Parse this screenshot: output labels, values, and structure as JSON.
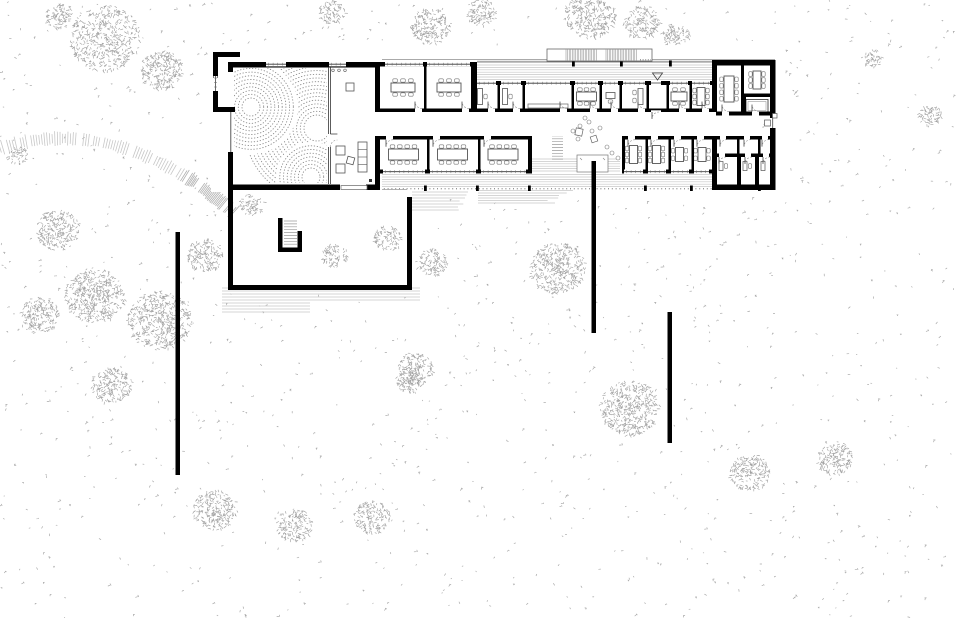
{
  "drawing": {
    "kind": "architectural-site-plan",
    "canvas": {
      "w": 960,
      "h": 618
    },
    "palette": {
      "paper": "#ffffff",
      "wall": "#000000",
      "thin_line": "#444444",
      "furniture": "#777777",
      "hatch": "#c7c7c7",
      "hatch_dark": "#9a9a9a",
      "stipple": "#a9a9a9",
      "zen_dots": "#8a8a8a",
      "door_arc": "#888888"
    },
    "stipple": {
      "count": 1300,
      "seed": 7,
      "exclude": [
        [
          208,
          44,
          575,
          150
        ],
        [
          225,
          183,
          192,
          110
        ]
      ]
    },
    "clusters": [
      [
        105,
        38,
        36
      ],
      [
        162,
        70,
        22
      ],
      [
        60,
        16,
        14
      ],
      [
        332,
        12,
        13
      ],
      [
        430,
        26,
        20
      ],
      [
        482,
        12,
        15
      ],
      [
        590,
        14,
        26
      ],
      [
        642,
        22,
        18
      ],
      [
        676,
        36,
        14
      ],
      [
        872,
        58,
        10
      ],
      [
        930,
        115,
        12
      ],
      [
        18,
        155,
        10
      ],
      [
        58,
        230,
        22
      ],
      [
        95,
        295,
        30
      ],
      [
        40,
        315,
        20
      ],
      [
        160,
        320,
        32
      ],
      [
        205,
        255,
        18
      ],
      [
        252,
        204,
        12
      ],
      [
        335,
        255,
        13
      ],
      [
        388,
        238,
        14
      ],
      [
        432,
        262,
        15
      ],
      [
        558,
        268,
        28
      ],
      [
        415,
        368,
        18
      ],
      [
        112,
        385,
        20
      ],
      [
        630,
        408,
        30
      ],
      [
        750,
        472,
        20
      ],
      [
        835,
        458,
        18
      ],
      [
        215,
        510,
        22
      ],
      [
        295,
        525,
        18
      ],
      [
        372,
        517,
        18
      ],
      [
        410,
        380,
        14
      ]
    ],
    "contour_band": {
      "p0": [
        0,
        148
      ],
      "p1": [
        118,
        112
      ],
      "p2": [
        232,
        212
      ],
      "ticks": 90
    },
    "hatch_blocks": [
      {
        "x1": 476,
        "x2": 712,
        "y": 62.6,
        "step": 2.4,
        "n": 8,
        "shrink": 0,
        "dir": "h"
      },
      {
        "x1": 382,
        "x2": 712,
        "y": 174.6,
        "step": 2.4,
        "n": 6,
        "shrink": 0,
        "dir": "h"
      },
      {
        "x1": 532,
        "x2": 620,
        "y": 159,
        "step": 2.4,
        "n": 6,
        "shrink": 0,
        "dir": "h"
      },
      {
        "x1": 412,
        "x2": 468,
        "y": 192,
        "step": 3,
        "n": 7,
        "shrink": 2,
        "dir": "h"
      },
      {
        "x1": 478,
        "x2": 573,
        "y": 190.5,
        "step": 2.5,
        "n": 6,
        "shrink": 5,
        "dir": "h"
      },
      {
        "x1": 222,
        "x2": 420,
        "y": 288,
        "step": 3,
        "n": 5,
        "shrink": 0,
        "dir": "h"
      },
      {
        "x1": 222,
        "x2": 310,
        "y": 303,
        "step": 3,
        "n": 4,
        "shrink": 0,
        "dir": "h"
      },
      {
        "x1": 552,
        "x2": 563,
        "y": 133,
        "step": 2.9,
        "n": 10,
        "shrink": 0,
        "dir": "h",
        "dark": true
      },
      {
        "x1": 284,
        "x2": 297,
        "y": 221,
        "step": 2.9,
        "n": 9,
        "shrink": 0,
        "dir": "h",
        "dark": true
      },
      {
        "x1": 749,
        "x2": 765,
        "y": 101.5,
        "step": 2.7,
        "n": 7,
        "len": 9,
        "dir": "v",
        "dark": true
      }
    ],
    "edge_lines": {
      "top": [
        378,
        775,
        59.8,
        61.8
      ],
      "dashdot_y": 188.8,
      "dashdot_x": [
        380,
        775
      ],
      "garden_gap_line": [
        380,
        407,
        189.5
      ]
    },
    "ticks_top": [
      572,
      620,
      669
    ],
    "ticks_south": [
      424,
      476,
      528,
      644,
      690,
      758
    ],
    "canopy": {
      "x": 547,
      "y": 49,
      "w": 105,
      "h": 12,
      "strips": [
        [
          566,
          598
        ],
        [
          606,
          638
        ]
      ],
      "dotted": [
        640,
        651,
        59.8
      ]
    },
    "white_fills": [
      [
        211,
        46,
        171,
        146
      ],
      [
        378,
        60,
        99,
        52
      ],
      [
        473,
        81,
        242,
        31
      ],
      [
        378,
        112,
        394,
        24
      ],
      [
        378,
        136,
        154,
        37
      ],
      [
        622,
        136,
        92,
        37
      ],
      [
        712,
        60,
        64,
        130
      ],
      [
        577,
        155,
        31,
        17
      ]
    ],
    "walls": [
      [
        233,
        62,
        147,
        5.5
      ],
      [
        228,
        62,
        5,
        10
      ],
      [
        228,
        152,
        5,
        38
      ],
      [
        228,
        184.5,
        112,
        5.5
      ],
      [
        366,
        184.5,
        14,
        5.5
      ],
      [
        375,
        62,
        5,
        50
      ],
      [
        375,
        136,
        5,
        54
      ],
      [
        213,
        52,
        27,
        5
      ],
      [
        213,
        52,
        5,
        26
      ],
      [
        213,
        91,
        5,
        21
      ],
      [
        213,
        107,
        22,
        5
      ],
      [
        378,
        62,
        97,
        4.5
      ],
      [
        424,
        66.5,
        2.5,
        42
      ],
      [
        471,
        62,
        6,
        50
      ],
      [
        473,
        81,
        242,
        4
      ],
      [
        497.5,
        85,
        2.5,
        24
      ],
      [
        522.5,
        85,
        2.5,
        24
      ],
      [
        571.5,
        85,
        2.5,
        24
      ],
      [
        599.5,
        85,
        2.5,
        24
      ],
      [
        619.5,
        85,
        2.5,
        24
      ],
      [
        646.5,
        85,
        2.5,
        24
      ],
      [
        666.5,
        85,
        2.5,
        24
      ],
      [
        689.5,
        85,
        2.5,
        24
      ],
      [
        380,
        108.5,
        332,
        3.5
      ],
      [
        380,
        136,
        150,
        3.5
      ],
      [
        622,
        136,
        90,
        3.5
      ],
      [
        427,
        139.5,
        2.5,
        30
      ],
      [
        478,
        139.5,
        2.5,
        30
      ],
      [
        528,
        136,
        4,
        37.5
      ],
      [
        622,
        136,
        3,
        37.5
      ],
      [
        645.5,
        139.5,
        2.5,
        30
      ],
      [
        668.5,
        139.5,
        2.5,
        30
      ],
      [
        691.5,
        139.5,
        2.5,
        30
      ],
      [
        378,
        169.5,
        152,
        4
      ],
      [
        622,
        169.5,
        93,
        4
      ],
      [
        712,
        60,
        5,
        52
      ],
      [
        712,
        136,
        5,
        54
      ],
      [
        712,
        60,
        63,
        5.5
      ],
      [
        770,
        60,
        5.5,
        58
      ],
      [
        770,
        128,
        5.5,
        62
      ],
      [
        712,
        184.5,
        63.5,
        5.5
      ],
      [
        741,
        65.5,
        3,
        46
      ],
      [
        743,
        93.5,
        27,
        3.5
      ],
      [
        743,
        97,
        3,
        14.5
      ],
      [
        716,
        111.5,
        56,
        4
      ],
      [
        716,
        136,
        56,
        3.5
      ],
      [
        716,
        153.5,
        56,
        3.5
      ],
      [
        737,
        139.5,
        2.5,
        14
      ],
      [
        758,
        139.5,
        2.5,
        14
      ],
      [
        737,
        157,
        4,
        28
      ],
      [
        755,
        157,
        4,
        28
      ]
    ],
    "windows_h": [
      [
        385,
        423,
        62
      ],
      [
        427,
        470,
        62
      ],
      [
        477,
        496,
        81
      ],
      [
        501,
        521,
        81
      ],
      [
        526,
        570,
        81
      ],
      [
        575,
        598,
        81
      ],
      [
        603,
        618,
        81
      ],
      [
        623,
        645,
        81
      ],
      [
        670,
        688,
        81
      ],
      [
        692,
        710,
        81
      ],
      [
        383,
        425,
        169.5
      ],
      [
        430,
        476,
        169.5
      ],
      [
        481,
        526,
        169.5
      ],
      [
        624,
        643,
        169.5
      ],
      [
        648,
        666,
        169.5
      ],
      [
        671,
        689,
        169.5
      ],
      [
        694,
        709,
        169.5
      ],
      [
        266,
        286,
        62
      ],
      [
        329,
        346,
        62
      ]
    ],
    "door_gaps_top": [
      415,
      462,
      488,
      513,
      560,
      590,
      611,
      638,
      679,
      702
    ],
    "door_gaps_bottom": [
      386,
      433,
      484,
      628,
      651,
      674,
      697
    ],
    "block_gaps": {
      "top_wall": [
        722,
        752
      ],
      "cell_wall": [
        720,
        744,
        762
      ],
      "mid_wall": [
        719,
        745,
        763
      ]
    },
    "vestibule": {
      "gap": [
        651,
        81,
        10,
        4
      ],
      "tri": [
        652.5,
        73,
        662.5,
        73,
        657.5,
        80
      ],
      "arc_hinge": [
        651,
        112
      ]
    },
    "east_door": {
      "gap": [
        770,
        118,
        5.5,
        10
      ],
      "fixture_in": [
        764.5,
        120,
        6,
        6
      ],
      "fixture_out": [
        772.5,
        113.5,
        4.5,
        4.5
      ]
    },
    "partition": {
      "x1": 328.6,
      "x2": 330.4,
      "y_top": [
        67,
        134
      ],
      "y_bot": [
        147,
        184
      ],
      "dots_y": 70.3,
      "dots_x": [
        333,
        339,
        345
      ]
    },
    "hall": {
      "west_window": [
        230.8,
        112,
        152
      ],
      "annex_window": [
        215.5,
        76,
        91
      ],
      "entrance": [
        341,
        185.5,
        26,
        4
      ],
      "lobby_items": {
        "squares": [
          [
            346,
            83,
            8,
            0
          ],
          [
            336,
            146,
            9,
            0
          ],
          [
            347,
            157,
            7,
            15
          ],
          [
            336,
            164,
            9,
            0
          ]
        ],
        "shelf": [
          358,
          142,
          9,
          30
        ],
        "dot": [
          369,
          179,
          3
        ]
      }
    },
    "zen": {
      "clip": [
        234,
        68,
        93,
        115
      ],
      "families": [
        {
          "c": [
            317,
            128
          ],
          "r0": 13,
          "r1": 73
        },
        {
          "c": [
            251,
            107
          ],
          "r0": 9,
          "r1": 46,
          "punch": 47
        },
        {
          "c": [
            311,
            177
          ],
          "r0": 9,
          "r1": 34,
          "punch": 35
        }
      ],
      "step": 3.7,
      "clearings": [
        [
          251,
          107,
          7.5
        ],
        [
          317,
          128,
          9
        ],
        [
          311,
          177,
          8
        ]
      ]
    },
    "rooms": [
      {
        "x": 382,
        "y": 67,
        "w": 42,
        "h": 41,
        "t": "m6h"
      },
      {
        "x": 427,
        "y": 67,
        "w": 44,
        "h": 41,
        "t": "m6h"
      },
      {
        "x": 475,
        "y": 85,
        "w": 22,
        "h": 23,
        "t": "deskwall"
      },
      {
        "x": 500,
        "y": 85,
        "w": 22,
        "h": 23,
        "t": "deskwall"
      },
      {
        "x": 525,
        "y": 85,
        "w": 46,
        "h": 23,
        "t": "cabinet"
      },
      {
        "x": 574,
        "y": 85,
        "w": 25,
        "h": 23,
        "t": "m6h",
        "tw": 20
      },
      {
        "x": 602,
        "y": 85,
        "w": 17,
        "h": 23,
        "t": "desk1"
      },
      {
        "x": 622,
        "y": 85,
        "w": 24,
        "h": 23,
        "t": "deskv"
      },
      {
        "x": 669,
        "y": 85,
        "w": 20,
        "h": 23,
        "t": "m4h"
      },
      {
        "x": 691,
        "y": 85,
        "w": 20,
        "h": 23,
        "t": "m6v"
      },
      {
        "x": 382,
        "y": 140,
        "w": 43,
        "h": 29,
        "t": "m8h"
      },
      {
        "x": 429,
        "y": 140,
        "w": 47,
        "h": 29,
        "t": "m8h"
      },
      {
        "x": 480,
        "y": 140,
        "w": 46,
        "h": 29,
        "t": "m8h"
      },
      {
        "x": 624,
        "y": 140,
        "w": 19,
        "h": 29,
        "t": "m6v"
      },
      {
        "x": 647,
        "y": 140,
        "w": 19,
        "h": 29,
        "t": "m6v"
      },
      {
        "x": 670,
        "y": 140,
        "w": 19,
        "h": 29,
        "t": "dp4"
      },
      {
        "x": 693,
        "y": 140,
        "w": 18,
        "h": 29,
        "t": "dp4"
      },
      {
        "x": 718,
        "y": 67,
        "w": 22,
        "h": 44,
        "t": "m8v"
      },
      {
        "x": 745,
        "y": 67,
        "w": 24,
        "h": 26,
        "t": "m6v"
      },
      {
        "x": 717,
        "y": 159,
        "w": 18,
        "h": 24,
        "t": "cell"
      },
      {
        "x": 741,
        "y": 159,
        "w": 13,
        "h": 24,
        "t": "cell"
      },
      {
        "x": 759,
        "y": 159,
        "w": 10,
        "h": 24,
        "t": "cell"
      }
    ],
    "stair_room": {
      "outer": [
        746,
        99.5,
        22,
        13
      ],
      "inner": [
        748,
        101.5,
        18,
        9
      ]
    },
    "lounge": {
      "circles": [
        [
          573,
          131
        ],
        [
          580,
          126
        ],
        [
          589,
          122
        ],
        [
          592,
          131
        ],
        [
          578,
          139
        ],
        [
          600,
          128
        ],
        [
          585,
          118
        ],
        [
          607,
          147
        ],
        [
          612,
          153
        ],
        [
          618,
          158
        ]
      ],
      "squares": [
        [
          579,
          132,
          7,
          12
        ],
        [
          594,
          139,
          6,
          -18
        ]
      ]
    },
    "alcove": {
      "rect": [
        577,
        155,
        31,
        17
      ]
    },
    "garden": {
      "walls": [
        [
          228,
          190,
          5,
          100
        ],
        [
          228,
          285,
          184,
          5
        ],
        [
          407,
          197,
          5,
          93
        ]
      ],
      "stair": [
        [
          278,
          218,
          4.5,
          34
        ],
        [
          278,
          247.5,
          24,
          4.5
        ],
        [
          297.5,
          231,
          4.5,
          21
        ]
      ]
    },
    "free_walls": [
      [
        175.5,
        232,
        4.5,
        243
      ],
      [
        591.5,
        161,
        4.5,
        172
      ],
      [
        667.5,
        312,
        4.5,
        131
      ]
    ]
  }
}
